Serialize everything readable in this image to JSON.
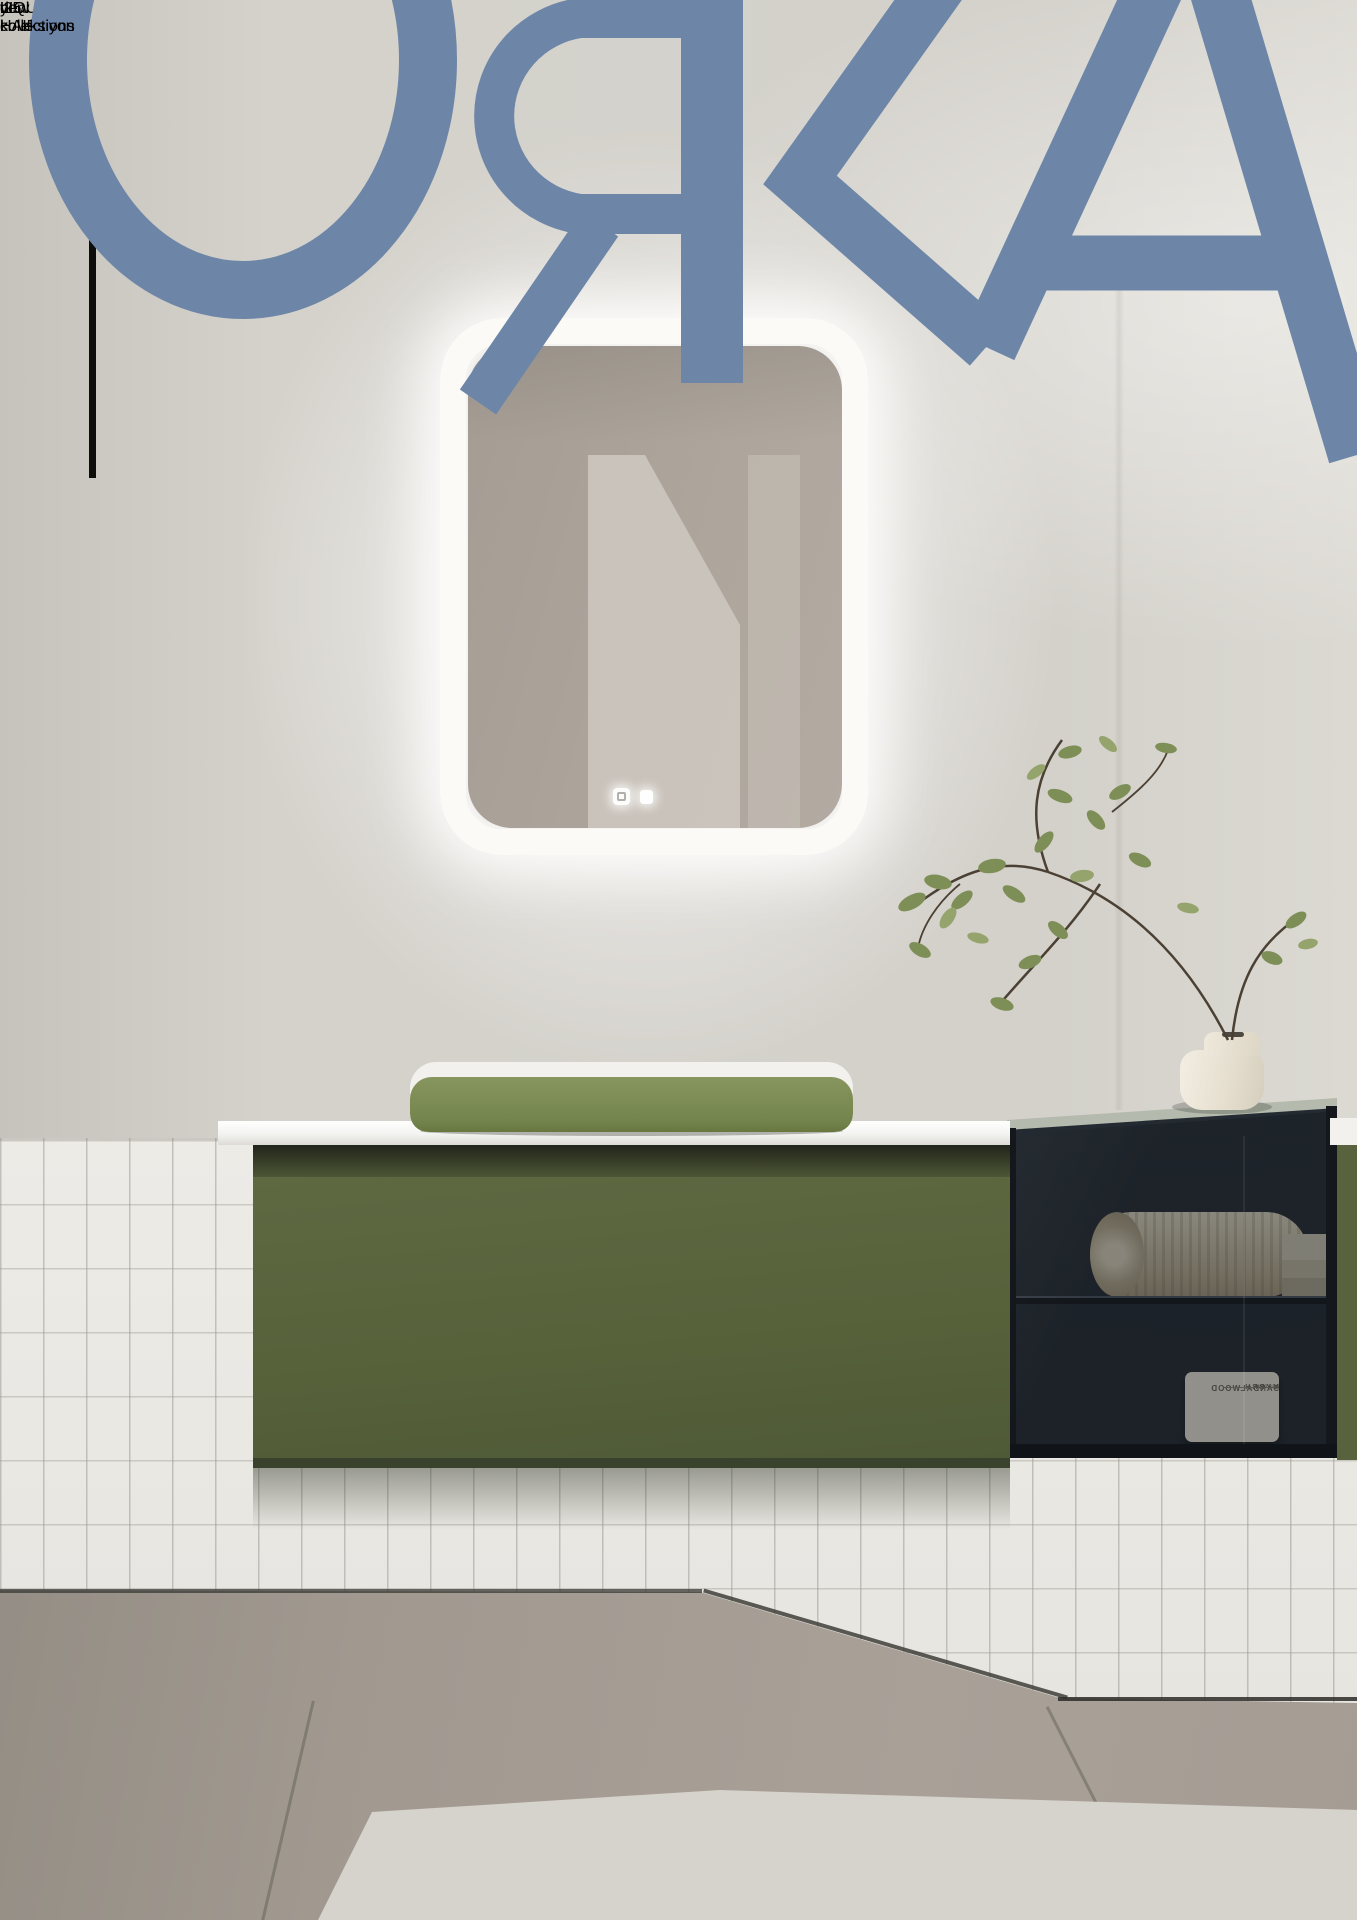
{
  "cover": {
    "brand_logo": "OЯKA",
    "tagline_line1": "yeni koleksiyon",
    "tagline_line2": "new collections",
    "year_mark": "’25"
  },
  "scene": {
    "bottle_label_line1": "LIQUID",
    "bottle_label_line2": "HAIRWASH",
    "bottle_label_mirrored": "true",
    "jar_letter": "d",
    "candle_line1": "SANDALWOOD",
    "candle_line2": "MYRRH",
    "candle_line3": "aurora",
    "candle_mirrored": "true"
  },
  "colors": {
    "logo_blue": "#6d86a7",
    "accent_magenta": "#ab33a0",
    "vanity_green": "#56613a",
    "basin_green": "#7d8c55",
    "glass_cabinet": "#272d34",
    "wall_grey": "#d4d1cb",
    "tile_white": "#eae8e3",
    "floor_grey": "#a19990",
    "stripe_white": "#fcfcfa"
  }
}
